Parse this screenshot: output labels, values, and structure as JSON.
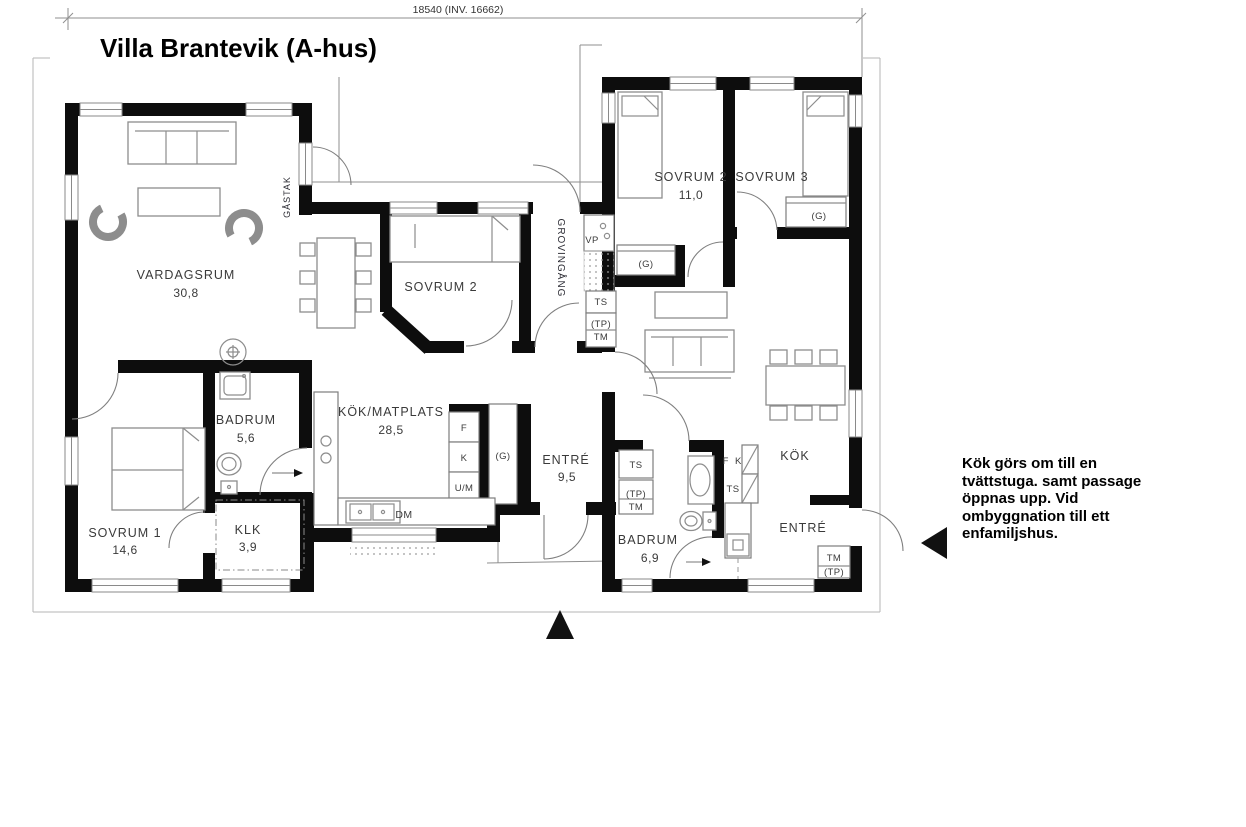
{
  "title": "Villa Brantevik (A-hus)",
  "dimension_top": "18540 (INV. 16662)",
  "left_house": {
    "vardagsrum": "VARDAGSRUM",
    "vardagsrum_area": "30,8",
    "sovrum2": "SOVRUM 2",
    "sovrum1": "SOVRUM 1",
    "sovrum1_area": "14,6",
    "badrum": "BADRUM",
    "badrum_area": "5,6",
    "klk": "KLK",
    "klk_area": "3,9",
    "kok_matplats": "KÖK/MATPLATS",
    "kok_matplats_area": "28,5",
    "entre": "ENTRÉ",
    "entre_area": "9,5",
    "gastak": "GÅSTAK",
    "grovingang": "GROVINGÅNG",
    "vp": "VP",
    "ts": "TS",
    "tp": "(TP)",
    "tm": "TM",
    "f": "F",
    "k": "K",
    "um": "U/M",
    "g": "(G)",
    "dm": "DM"
  },
  "right_house": {
    "sovrum2": "SOVRUM 2",
    "sovrum2_area": "11,0",
    "sovrum3": "SOVRUM 3",
    "g1": "(G)",
    "g2": "(G)",
    "kok": "KÖK",
    "entre": "ENTRÉ",
    "badrum": "BADRUM",
    "badrum_area": "6,9",
    "ts": "TS",
    "tp": "(TP)",
    "tm": "TM",
    "fk": "F K"
  },
  "note": {
    "line1": "Kök görs om till en",
    "line2": "tvättstuga. samt passage",
    "line3": "öppnas upp. Vid",
    "line4": "ombyggnation till ett",
    "line5": "enfamiljshus."
  },
  "colors": {
    "wall": "#0d0d0d",
    "line": "#8f8f8f",
    "text": "#3a3a3a"
  }
}
